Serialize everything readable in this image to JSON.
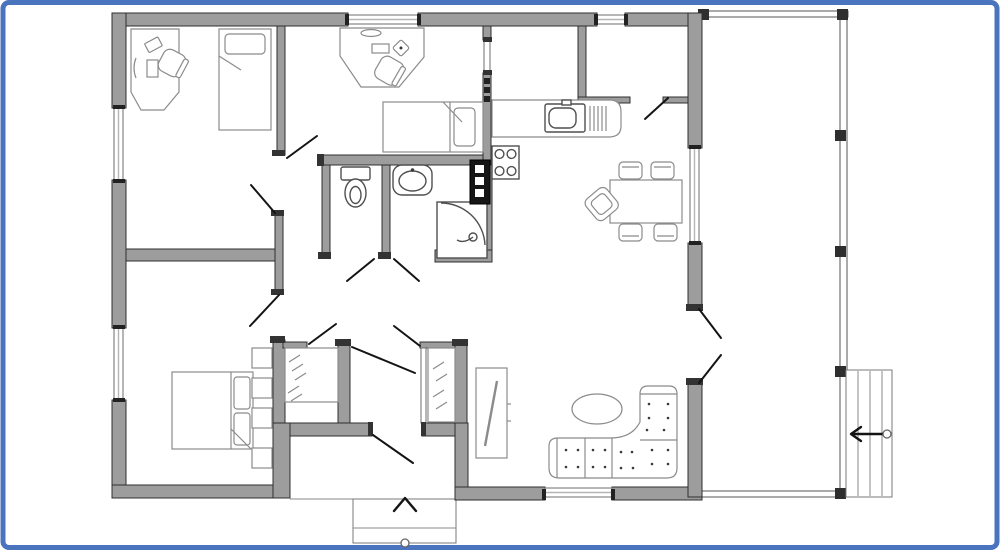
{
  "frame": {
    "color": "#4a74bd",
    "corner_radius": 6
  },
  "palette": {
    "wall_fill": "#9d9d9d",
    "wall_stroke": "#2f2f2f",
    "interior_cap": "#333333",
    "window_stroke": "#6e6e6e",
    "window_glass": "#b5b5b5",
    "furniture_stroke": "#8b8b8b",
    "fixture_stroke": "#4f4f4f",
    "door_line": "#141414",
    "railing_stroke": "#555555",
    "post_fill": "#2e2e2e",
    "floor": "#ffffff"
  },
  "plan": {
    "type": "single-storey-house-floor-plan",
    "rooms": [
      {
        "name": "office-bedroom",
        "furniture": [
          "desk",
          "desk-chair",
          "single-bed"
        ]
      },
      {
        "name": "kids-bedroom",
        "furniture": [
          "corner-desk",
          "desk-chair",
          "single-bed"
        ]
      },
      {
        "name": "wc",
        "furniture": [
          "toilet"
        ]
      },
      {
        "name": "bathroom",
        "furniture": [
          "washbasin",
          "shower-cabin",
          "water-heater"
        ]
      },
      {
        "name": "kitchen",
        "furniture": [
          "kitchen-counter",
          "kitchen-sink",
          "stove-4-burner",
          "dish-rack"
        ]
      },
      {
        "name": "pantry",
        "furniture": []
      },
      {
        "name": "dining-area",
        "furniture": [
          "dining-table",
          "dining-chair",
          "dining-chair",
          "dining-chair",
          "dining-chair",
          "dining-armchair"
        ]
      },
      {
        "name": "living-area",
        "furniture": [
          "corner-sofa",
          "oval-coffee-table",
          "tv-cabinet"
        ]
      },
      {
        "name": "master-bedroom",
        "furniture": [
          "double-bed",
          "shelf-column"
        ]
      },
      {
        "name": "closet-left",
        "furniture": [
          "clothes-rail"
        ]
      },
      {
        "name": "closet-right",
        "furniture": [
          "clothes-rail"
        ]
      },
      {
        "name": "entry-hall",
        "furniture": [
          "front-door",
          "entry-steps"
        ]
      },
      {
        "name": "veranda",
        "furniture": [
          "railing",
          "side-steps"
        ]
      }
    ],
    "markers": {
      "front_entry_arrow": "up",
      "veranda_steps_arrow": "left",
      "entry_point_circles": 2
    }
  }
}
